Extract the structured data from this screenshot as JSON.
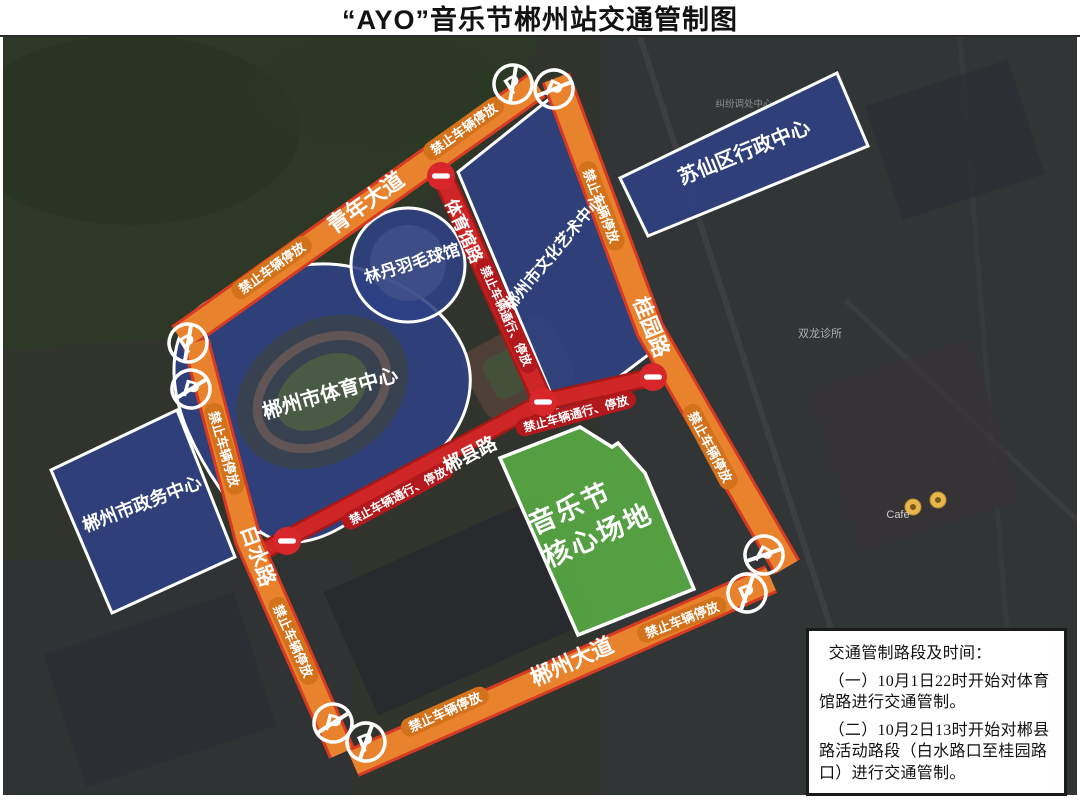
{
  "title": "“AYO”音乐节郴州站交通管制图",
  "legend": {
    "no_parking": "禁止车辆停放",
    "no_passing_parking": "禁止车辆通行、停放",
    "p_letter": "P"
  },
  "roads": {
    "qingnian": "青年大道",
    "guiyuan": "桂园路",
    "baishui": "白水路",
    "chenzhou": "郴州大道",
    "tiyuguan": "体育馆路",
    "chenxian": "郴县路"
  },
  "areas": {
    "culture": "郴州市文化艺术中心",
    "suxian": "苏仙区行政中心",
    "sports": "郴州市体育中心",
    "badminton": "林丹羽毛球馆",
    "government": "郴州市政务中心"
  },
  "venue": {
    "line1": "音乐节",
    "line2": "核心场地"
  },
  "notice": {
    "heading": "交通管制路段及时间：",
    "item1": "（一）10月1日22时开始对体育馆路进行交通管制。",
    "item2": "（二）10月2日13时开始对郴县路活动路段（白水路口至桂园路口）进行交通管制。"
  },
  "map_labels": {
    "clinic": "双龙诊所",
    "dispute": "纠纷调处中心",
    "cafe": "Cafe"
  },
  "colors": {
    "road_orange": "#E8822C",
    "road_red_border": "#D63A22",
    "closed_road_red": "#CE2626",
    "zone_blue": "#2E4184",
    "venue_green": "#55A343",
    "no_entry_red": "#D7272B"
  }
}
